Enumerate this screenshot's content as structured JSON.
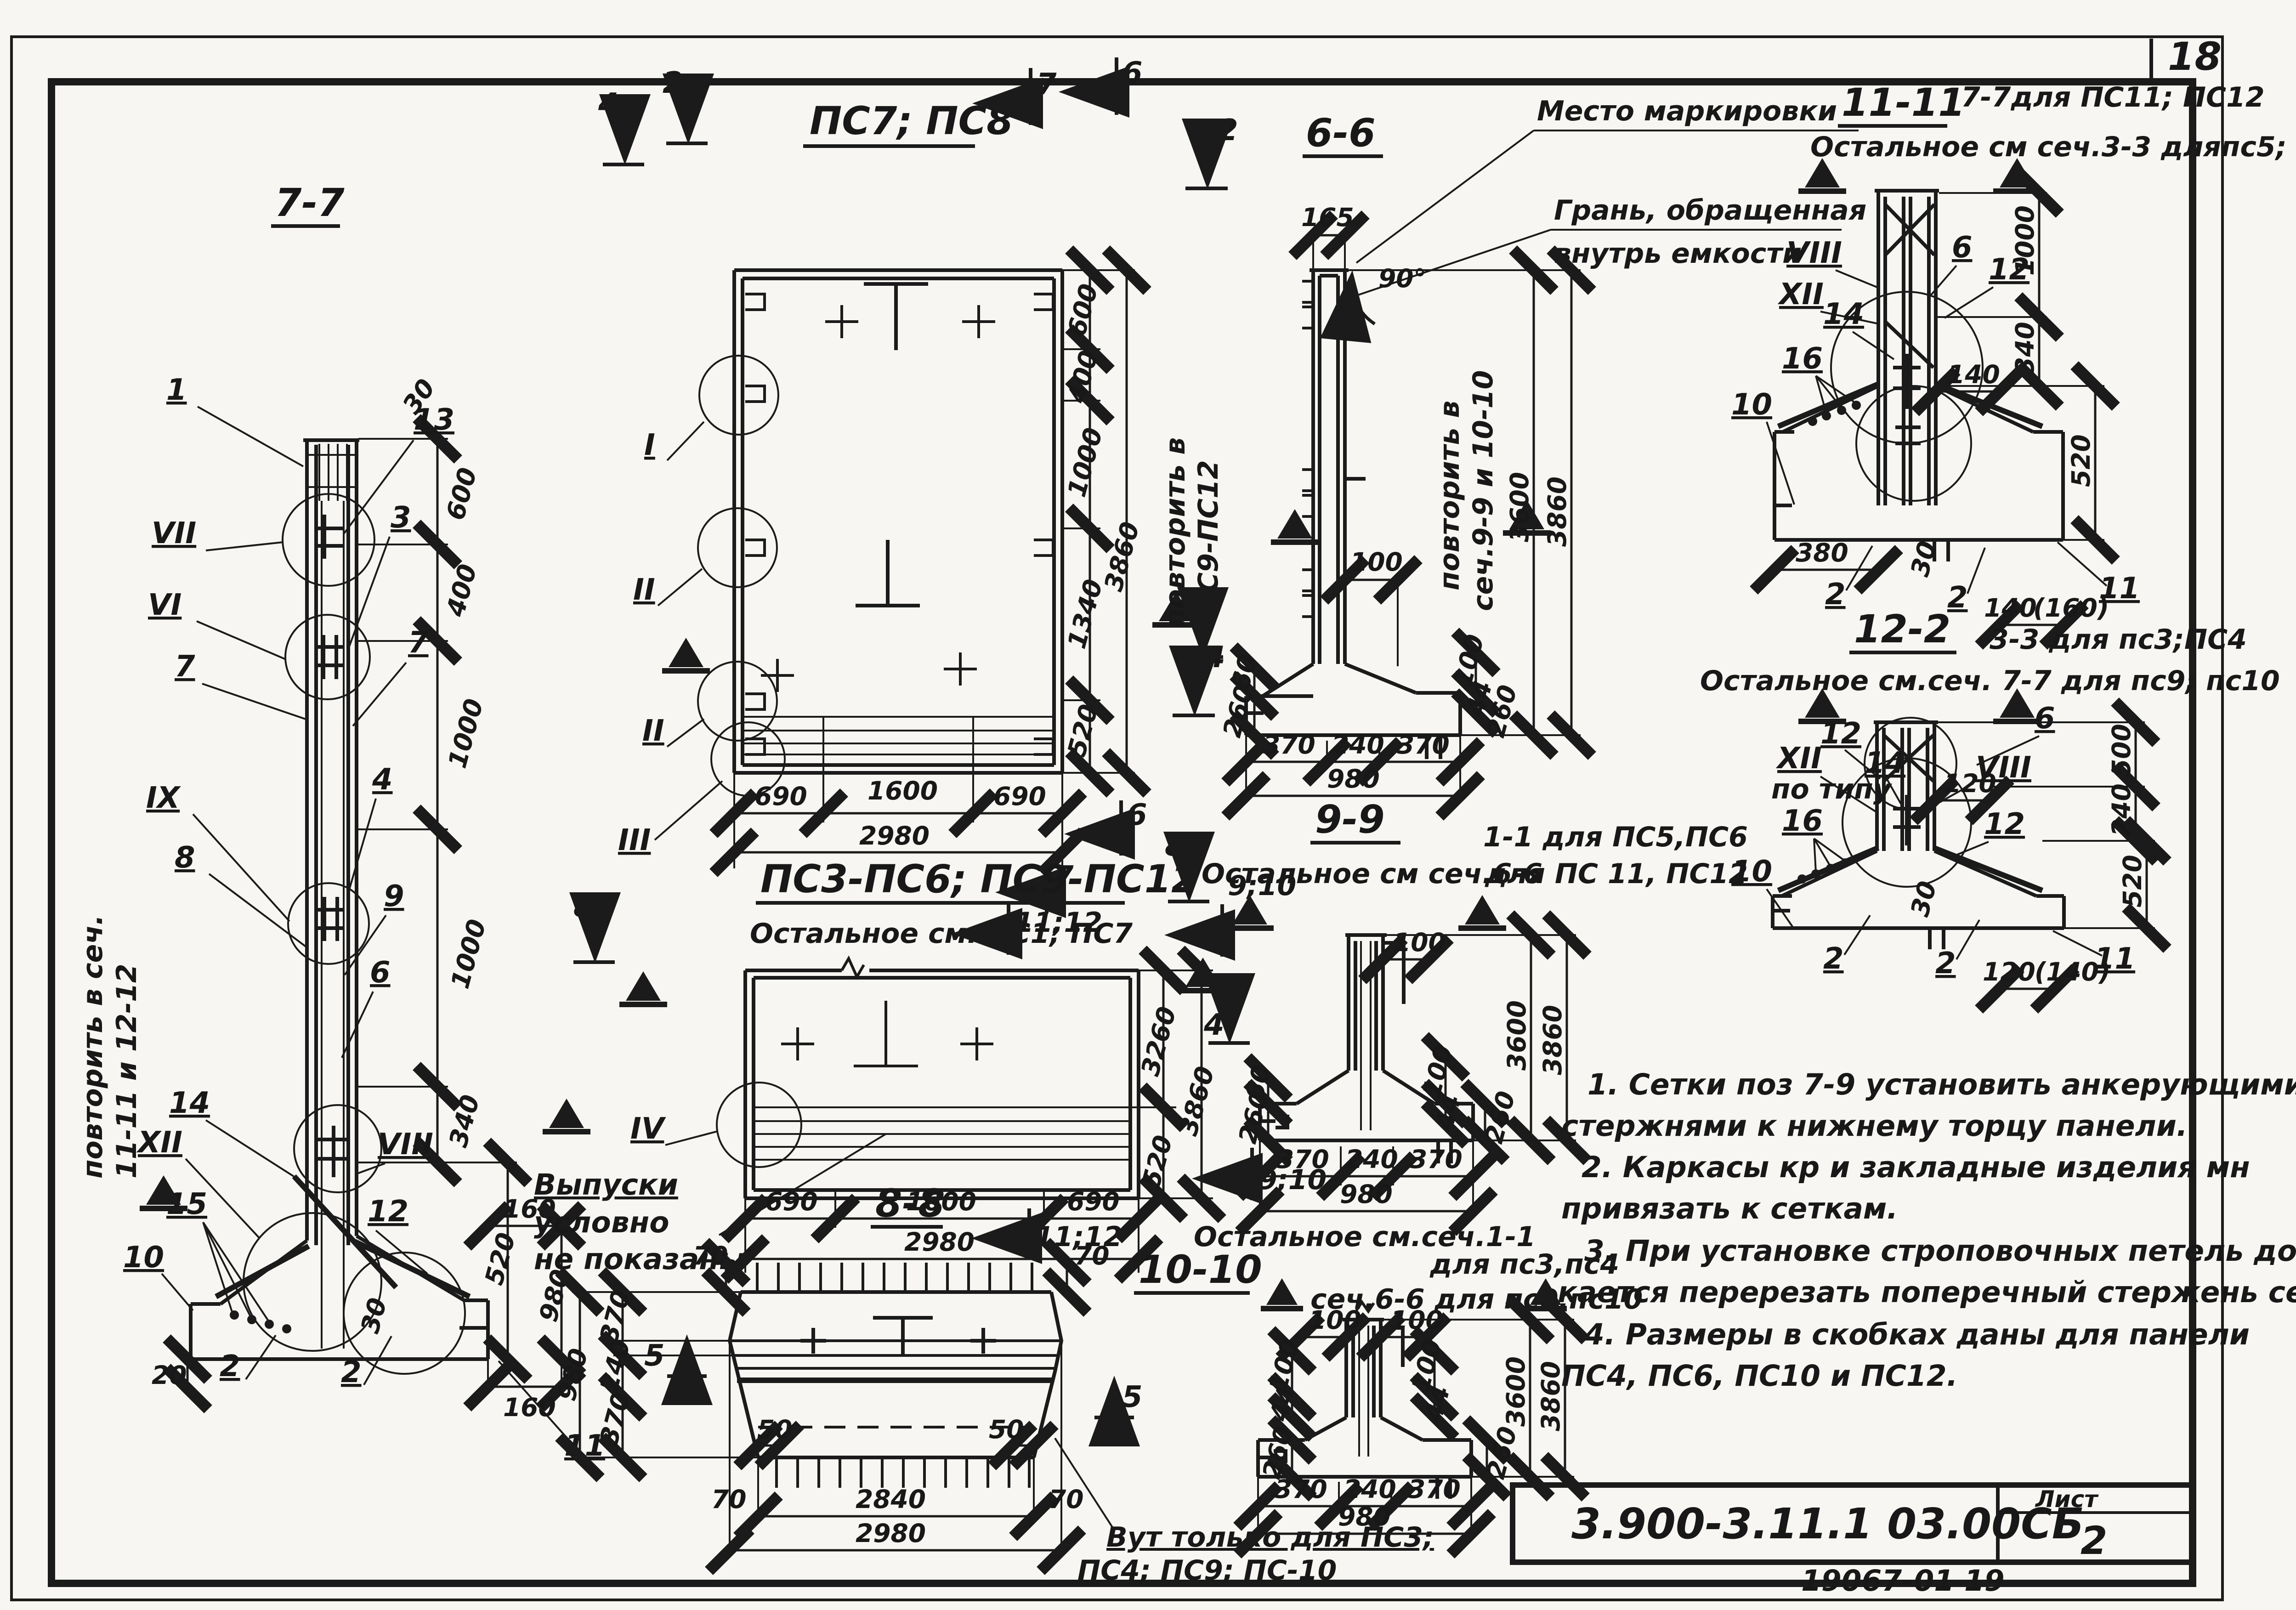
{
  "page": {
    "corner_number": "18",
    "doc_code": "3.900-3.11.1   03.00СБ",
    "sheet_label": "Лист",
    "sheet_number": "2",
    "stamp": "19067-01  19"
  },
  "notes": {
    "l1": "1. Сетки поз 7-9 установить анкерующими",
    "l2": "стержнями к нижнему торцу панели.",
    "l3": "2. Каркасы кр и закладные изделия мн",
    "l4": "привязать к сеткам.",
    "l5": "3. При установке строповочных петель допус-",
    "l6": "кается перерезать поперечный стержень сетки.",
    "l7": "4. Размеры в скобках даны для панели",
    "l8": "ПС4, ПС6, ПС10 и ПС12."
  },
  "s77": {
    "title": "7-7",
    "p1": "1",
    "p13": "13",
    "p3": "3",
    "p7": "7",
    "p4": "4",
    "p8": "8",
    "p9": "9",
    "p6": "6",
    "p14": "14",
    "p15": "15",
    "p10": "10",
    "p12": "12",
    "p2": "2",
    "p11": "11",
    "r7": "VII",
    "r6": "VI",
    "r9": "IX",
    "r12": "XII",
    "r8": "VIII",
    "d30": "30",
    "d600": "600",
    "d400": "400",
    "d1000": "1000",
    "d340": "340",
    "d160": "160",
    "d520": "520",
    "d980": "980",
    "d20": "20",
    "note1": "повторить в сеч.",
    "note2": "11-11 и 12-12"
  },
  "pc78": {
    "title": "ПС7; ПС8",
    "m7": "7",
    "m6": "6",
    "m2": "2",
    "m4": "4",
    "rI": "I",
    "rII": "II",
    "rIII": "III",
    "d600": "600",
    "d400": "400",
    "d1000": "1000",
    "d1340": "1340",
    "d520": "520",
    "d3860": "3860",
    "rot1": "повторить в",
    "rot2": "ПС9-ПС12",
    "d690": "690",
    "d1600": "1600",
    "d2980": "2980"
  },
  "s66": {
    "title": "6-6",
    "mark": "Место маркировки",
    "edge1": "Грань, обращенная",
    "edge2": "внутрь емкости",
    "d165": "165",
    "d90": "90°",
    "d100": "100",
    "rot1": "повторить в",
    "rot2": "сеч.9-9 и 10-10",
    "m4": "4",
    "d3600": "3600",
    "d3860": "3860",
    "d60": "60",
    "d260": "260",
    "d44": "44",
    "d370": "370",
    "d240": "240",
    "d980": "980"
  },
  "s1111": {
    "title": "11-11",
    "sub1": "7-7для ПС11; ПС12",
    "sub2": "Остальное см сеч.3-3 дляпс5; пс6",
    "r8": "VIII",
    "r12": "XII",
    "p14": "14",
    "p16": "16",
    "p10": "10",
    "p6": "6",
    "p12": "12",
    "p2": "2",
    "p11": "11",
    "d1000": "1000",
    "d340": "340",
    "d140": "140",
    "d520": "520",
    "d380": "380",
    "d30": "30",
    "d160p": "(160)"
  },
  "s122": {
    "title": "12-2",
    "sub1": "3-3 для пс3;ПС4",
    "sub2": "Остальное см.сеч. 7-7 для пс9; пс10",
    "r12": "XII",
    "potipu": "по типу",
    "r8": "VIII",
    "p14": "14",
    "p16": "16",
    "p10": "10",
    "p12": "12",
    "p6": "6",
    "p2": "2",
    "p11": "11",
    "d500": "500",
    "d240": "240",
    "d520": "520",
    "d120": "120",
    "d30": "30",
    "d140p": "(140)"
  },
  "pc312": {
    "title": "ПС3-ПС6; ПС9-ПС12",
    "sub": "Остальное см. ПС1; ПС7",
    "m8": "8",
    "m1112": "11;12",
    "m910": "9;10",
    "rIV": "IV",
    "d3260": "3260",
    "d3860": "3860",
    "d520": "520",
    "d690": "690",
    "d1600": "1600",
    "d2980": "2980",
    "out1": "Выпуски",
    "out2": "условно",
    "out3": "не показаны"
  },
  "s88": {
    "title": "8-8",
    "d70": "70",
    "d370": "370",
    "d240": "240",
    "d980": "980",
    "m5": "5",
    "d50": "50",
    "d2840": "2840",
    "d2980": "2980",
    "vut1": "Вут только для ПС3;",
    "vut2": "ПС4; ПС9; ПС-10"
  },
  "s99": {
    "title": "9-9",
    "sub1": "1-1 для ПС5,ПС6",
    "sub2": "Остальное см сеч.6-6",
    "sub3": "для ПС 11, ПС12",
    "m4": "4",
    "m8": "8",
    "d100": "100",
    "d3600": "3600",
    "d3860": "3860",
    "d260": "260",
    "d60": "60",
    "d44": "44",
    "d370": "370",
    "d240": "240",
    "d980": "980"
  },
  "s1010": {
    "title": "10-10",
    "sub1": "Остальное см.сеч.1-1",
    "sub2": "для пс3,пс4",
    "sub3": "сеч.6-6 для пс9,пс10",
    "d100": "100",
    "d44": "44",
    "d260": "260",
    "d3600": "3600",
    "d3860": "3860",
    "d370": "370",
    "d240": "240",
    "d980": "980"
  }
}
